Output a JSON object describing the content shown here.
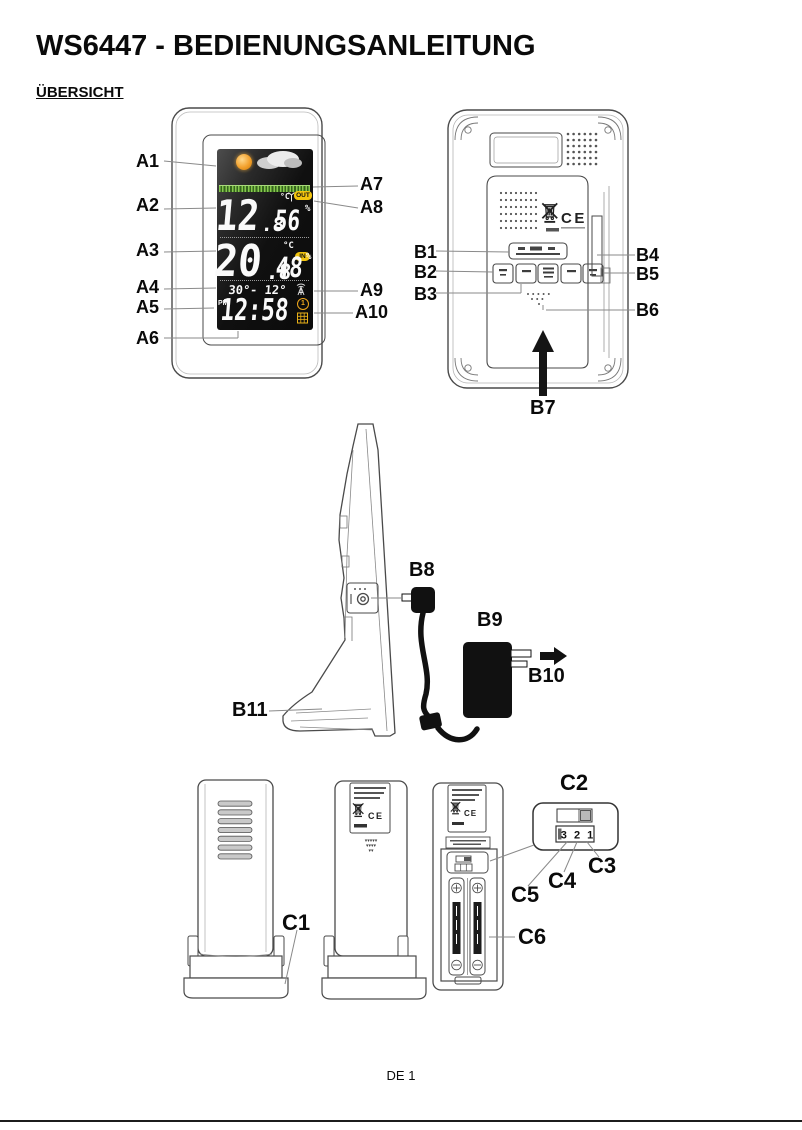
{
  "page": {
    "title": "WS6447 - BEDIENUNGSANLEITUNG",
    "section_heading": "ÜBERSICHT",
    "page_number": "DE 1"
  },
  "figure_labels": {
    "a1": "A1",
    "a2": "A2",
    "a3": "A3",
    "a4": "A4",
    "a5": "A5",
    "a6": "A6",
    "a7": "A7",
    "a8": "A8",
    "a9": "A9",
    "a10": "A10",
    "b1": "B1",
    "b2": "B2",
    "b3": "B3",
    "b4": "B4",
    "b5": "B5",
    "b6": "B6",
    "b7": "B7",
    "b8": "B8",
    "b9": "B9",
    "b10": "B10",
    "b11": "B11",
    "c1": "C1",
    "c2": "C2",
    "c3": "C3",
    "c4": "C4",
    "c5": "C5",
    "c6": "C6"
  },
  "display": {
    "outdoor_temp": "12",
    "outdoor_temp_decimal": ".8",
    "outdoor_temp_unit": "°C",
    "outdoor_badge": "OUT",
    "outdoor_humidity": "56",
    "indoor_temp": "20",
    "indoor_temp_decimal": ".8",
    "indoor_temp_unit": "°C",
    "indoor_badge": "IN",
    "indoor_humidity": "48",
    "humidity_unit": "%",
    "minmax_row": "30°- 12°",
    "meridiem": "PM",
    "time": "12:58",
    "alarm_number": "1"
  },
  "marks": {
    "ce_mark": "CE",
    "dip_switch_numbers": "3 2 1"
  },
  "colors": {
    "lcd_background": "#101010",
    "badge_yellow": "#f2c40e",
    "sun_orange": "#f0a02c",
    "trend_bar_green": "#6cbb3c",
    "lcd_digits": "#ffffff",
    "line_art": "#4a4a4a"
  }
}
